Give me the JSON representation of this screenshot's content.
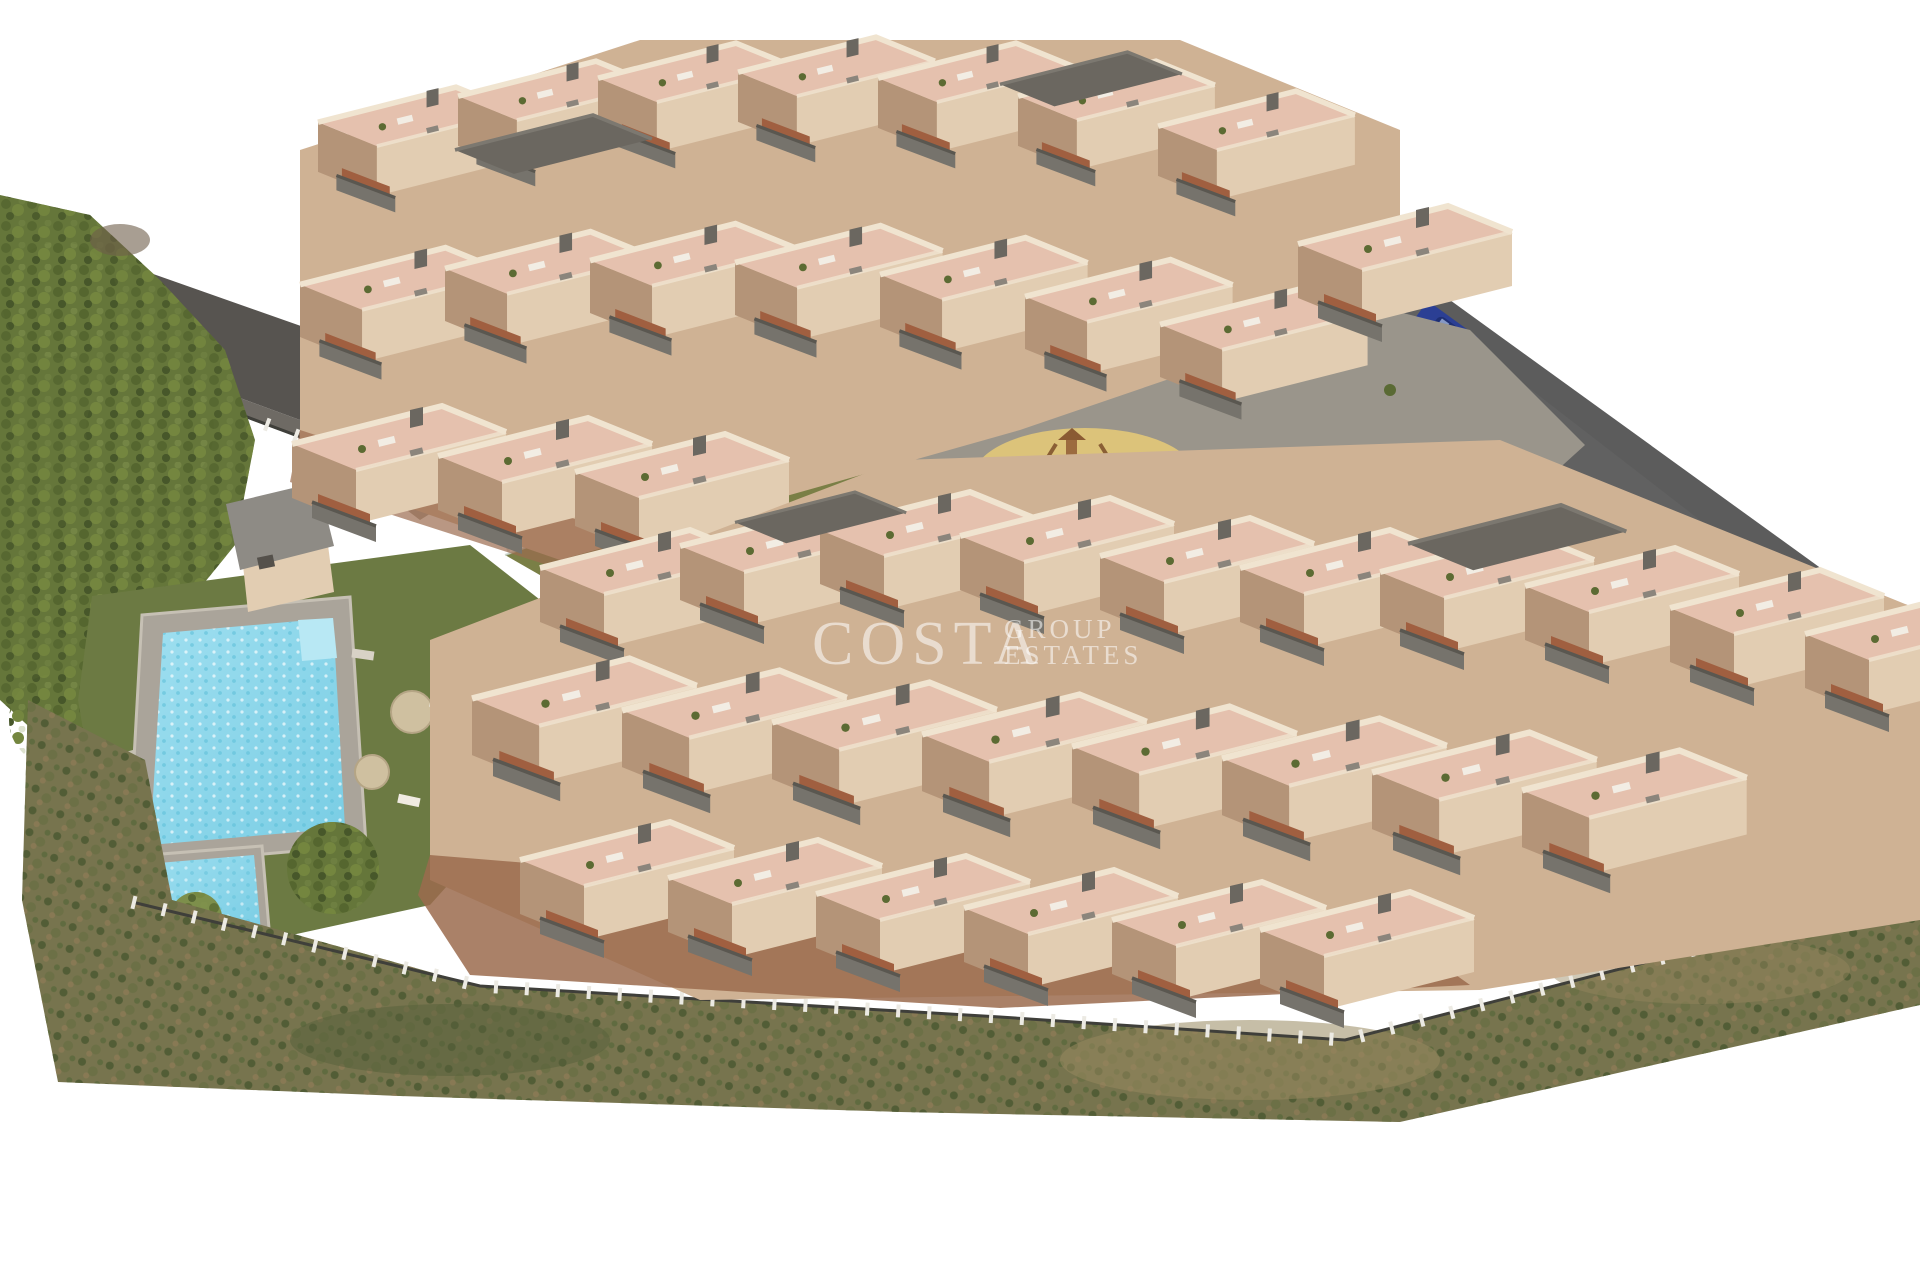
{
  "watermark": {
    "brand": "COSTA",
    "group": "GROUP",
    "estates": "ESTATES"
  },
  "colors": {
    "bg": "#ffffff",
    "road": "#616161",
    "road-dark": "#535353",
    "terrace": "#e5c1ae",
    "terrace-light": "#eed3c2",
    "wall": "#e2cdb2",
    "wall-light": "#f0e4d0",
    "wall-shadow": "#b49478",
    "base-mass": "#cfb294",
    "under-shadow": "#9b6b4e",
    "balcony": "#76736c",
    "balcony-dark": "#5a5750",
    "stairs": "#a05f40",
    "roof-dark": "#6b6760",
    "paving": "#9a958b",
    "paving-dark": "#88837a",
    "ramp": "#c9b697",
    "lawn": "#6c7a43",
    "lawn-dark": "#5f6c3a",
    "tree": "#65763a",
    "tree-dark": "#4d5e2c",
    "tree-light": "#7d8f4b",
    "bush-purple": "#7b4950",
    "scrub": "#77744e",
    "scrub-brown": "#97885f",
    "scrub-dark": "#55603a",
    "pool-deck": "#aaa49a",
    "pool": "#85d4e8",
    "pool-light": "#b8e8f4",
    "sand": "#dcc37a",
    "fence-white": "#eceae3",
    "fence-dark": "#3f3f3a",
    "umbrella": "#cfc0a0",
    "car": "#2b3f94",
    "car-dark": "#1e2f73",
    "watermark": "rgba(255,255,255,0.55)"
  }
}
